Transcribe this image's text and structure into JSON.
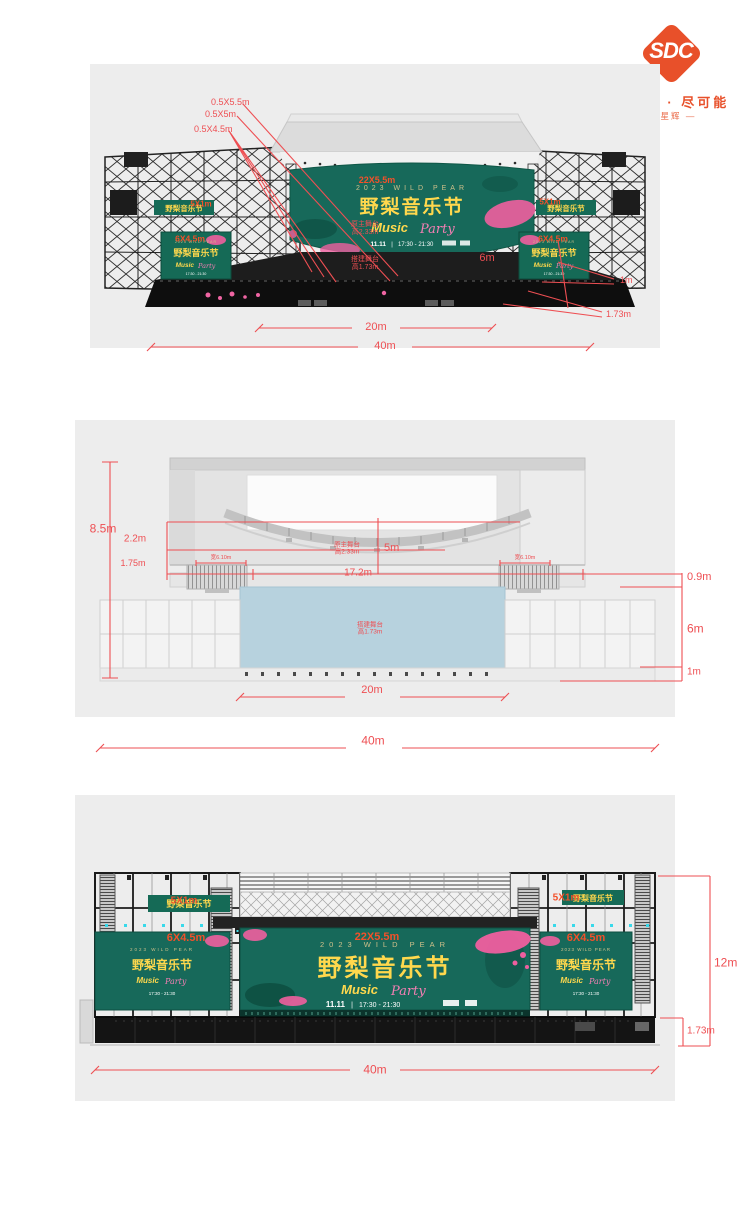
{
  "logo": {
    "text": "SDC",
    "tagline": "为可能 · 尽可能",
    "subtitle": "— 星辉 —"
  },
  "banner": {
    "top": "2023 WILD PEAR",
    "title": "野梨音乐节",
    "music": "Music",
    "party": "Party",
    "sep": "|",
    "date": "11.11",
    "time": "17:30 - 21:30"
  },
  "perspective": {
    "truss_labels": [
      "0.5X5.5m",
      "0.5X5m",
      "0.5X4.5m"
    ],
    "screen_main": "22X5.5m",
    "screen_strip_left": "5X1m",
    "screen_strip_right": "5X1m",
    "screen_side_left": "6X4.5m",
    "screen_side_right": "6X4.5m",
    "stage_main_name": "原主舞台",
    "stage_main_height": "高2.33m",
    "stage_built_name": "搭建舞台",
    "stage_built_height": "高1.73m",
    "dim_depth": "6m",
    "dim_inner_width": "20m",
    "dim_outer_width": "40m",
    "dim_platform_height": "1m",
    "dim_platform_depth": "1.73m"
  },
  "side_view": {
    "dim_total_height": "8.5m",
    "dim_screen_height": "2.2m",
    "dim_clearance": "1.75m",
    "stage_main_name": "原主舞台",
    "stage_main_height": "高2.33m",
    "dim_drop": "5m",
    "dim_span": "17.2m",
    "dim_edge": "0.9m",
    "dim_stage_depth": "6m",
    "dim_platform_height": "1m",
    "stage_built_name": "搭建舞台",
    "stage_built_height": "高1.73m",
    "speaker_width_left": "宽6.10m",
    "speaker_width_right": "宽6.10m",
    "dim_inner_width": "20m",
    "dim_outer_width": "40m"
  },
  "front_view": {
    "screen_strip_left": "5X1m",
    "screen_strip_right": "5X1m",
    "screen_side_left": "6X4.5m",
    "screen_main": "22X5.5m",
    "screen_side_right": "6X4.5m",
    "dim_height": "12m",
    "dim_base_height": "1.73m",
    "dim_outer_width": "40m"
  },
  "colors": {
    "dim_red": "#ee4f53",
    "label_orange": "#f3512a",
    "logo_orange": "#e8502a",
    "banner_green": "#17695a",
    "banner_yellow": "#ffd84d",
    "banner_pink": "#f57fb4",
    "stage_blue": "#b7d2de",
    "panel_gray": "#ededed",
    "stage_black": "#141414"
  }
}
